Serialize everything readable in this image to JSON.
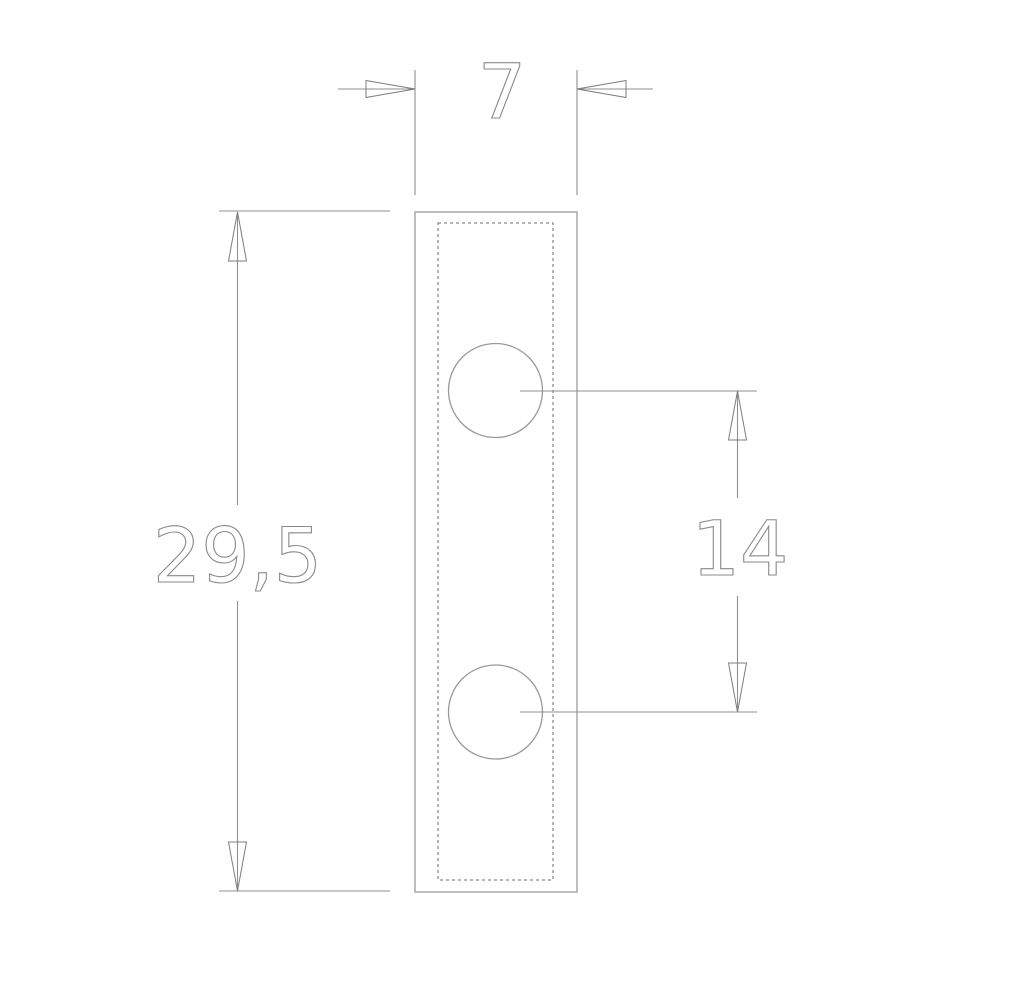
{
  "drawing": {
    "type": "technical-drawing",
    "view": "front-view-plate-with-two-holes",
    "dimensions": {
      "width": {
        "label": "7"
      },
      "height": {
        "label": "29,5"
      },
      "hole_spacing": {
        "label": "14"
      }
    },
    "colors": {
      "geometry_line": "#9a9a9a",
      "hidden_line_dashed": "#8b8b8b",
      "dimension_line": "#8f8f8f",
      "dimension_text": "#8a8a8a",
      "background": "#ffffff"
    }
  }
}
